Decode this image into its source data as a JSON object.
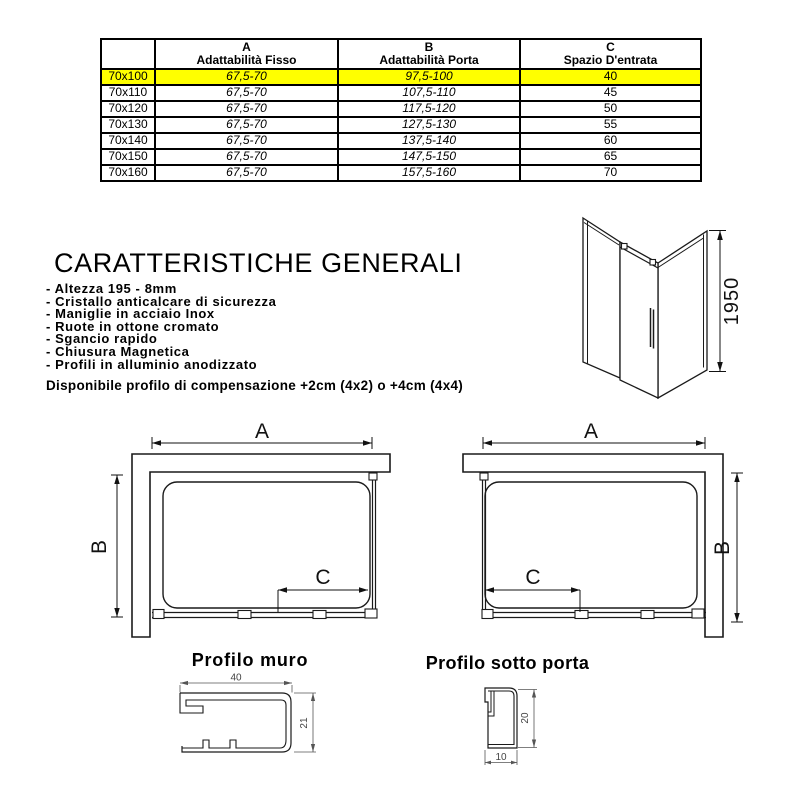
{
  "size_table": {
    "corner": "",
    "col_a": {
      "letter": "A",
      "label": "Adattabilità Fisso"
    },
    "col_b": {
      "letter": "B",
      "label": "Adattabilità Porta"
    },
    "col_c": {
      "letter": "C",
      "label": "Spazio D'entrata"
    },
    "highlight_color": "#ffff00",
    "rows": [
      {
        "size": "70x100",
        "fisso": "67,5-70",
        "porta": "97,5-100",
        "spazio": "40"
      },
      {
        "size": "70x110",
        "fisso": "67,5-70",
        "porta": "107,5-110",
        "spazio": "45"
      },
      {
        "size": "70x120",
        "fisso": "67,5-70",
        "porta": "117,5-120",
        "spazio": "50"
      },
      {
        "size": "70x130",
        "fisso": "67,5-70",
        "porta": "127,5-130",
        "spazio": "55"
      },
      {
        "size": "70x140",
        "fisso": "67,5-70",
        "porta": "137,5-140",
        "spazio": "60"
      },
      {
        "size": "70x150",
        "fisso": "67,5-70",
        "porta": "147,5-150",
        "spazio": "65"
      },
      {
        "size": "70x160",
        "fisso": "67,5-70",
        "porta": "157,5-160",
        "spazio": "70"
      }
    ]
  },
  "general": {
    "title": "CARATTERISTICHE GENERALI",
    "items": [
      "- Altezza 195 - 8mm",
      "- Cristallo anticalcare di sicurezza",
      "- Maniglie in acciaio Inox",
      "- Ruote in ottone cromato",
      "- Sgancio rapido",
      "- Chiusura Magnetica",
      "- Profili in alluminio anodizzato"
    ],
    "note": "Disponibile profilo di compensazione +2cm (4x2) o +4cm (4x4)"
  },
  "iso": {
    "height_label": "1950"
  },
  "plan_left": {
    "a": "A",
    "b": "B",
    "c": "C"
  },
  "plan_right": {
    "a": "A",
    "b": "B",
    "c": "C"
  },
  "profile_muro": {
    "title": "Profilo muro",
    "width_label": "40",
    "height_label": "21"
  },
  "profile_porta": {
    "title": "Profilo sotto porta",
    "width_label": "10",
    "height_label": "20"
  }
}
